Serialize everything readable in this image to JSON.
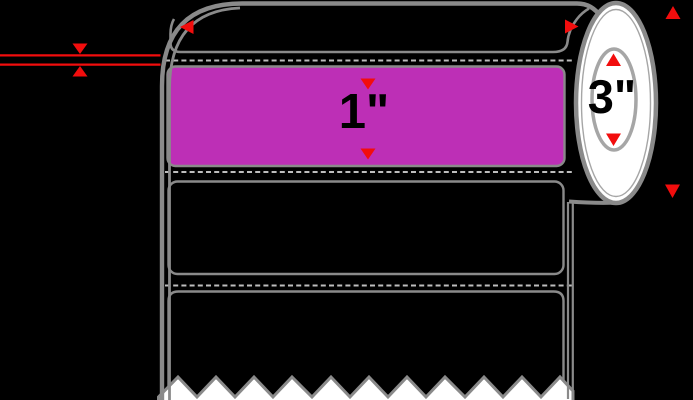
{
  "title": "Label roll specification diagram",
  "colors": {
    "background": "#000000",
    "outline": "#8a8a8a",
    "rim": "#a6a6a6",
    "dash": "#bdbdbd",
    "red": "#f20d0d",
    "magenta": "#bd2fb6",
    "paper": "#ffffff",
    "ink": "#000000"
  },
  "annotations": {
    "label_height": "1\"",
    "core_diameter": "3\""
  },
  "icons": {
    "gap_arrows": "red triangles pointing at gap lines",
    "width_arrows": "red left/right triangles across roll top",
    "core_arrows": "red up/down triangles inside core",
    "od_arrows": "red up/down triangles at right edge"
  }
}
